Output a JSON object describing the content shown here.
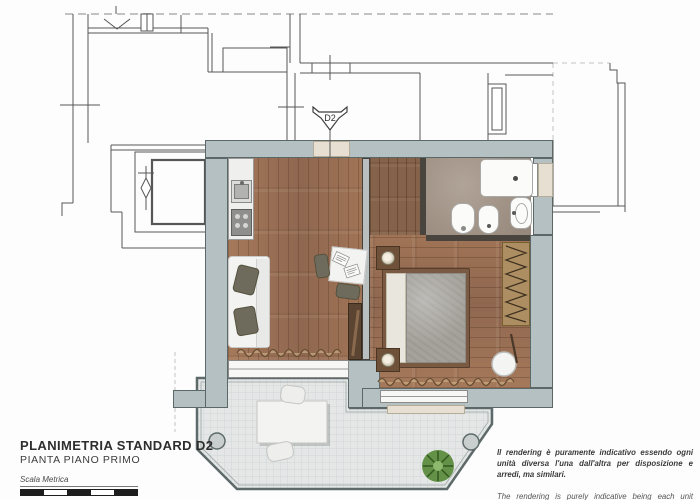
{
  "title_block": {
    "title": "PLANIMETRIA STANDARD D2",
    "subtitle": "PIANTA PIANO PRIMO",
    "scale_label": "Scala Metrica",
    "scale_ticks": [
      "0",
      "0,5",
      "1",
      "1,5",
      "2",
      "2,5"
    ]
  },
  "unit_marker": {
    "label": "D2"
  },
  "disclaimer": {
    "italian": "Il rendering è puramente indicativo essendo ogni unità diversa l'una dall'altra per disposizione e arredi, ma similari.",
    "english": "The rendering is purely indicative being each unit different from each other in layout and furnishings, but similar."
  },
  "colors": {
    "wall": "#b4c0c1",
    "wood_floor": "#9c7257",
    "hall_wood": "#85624a",
    "bathroom_floor": "#a39486",
    "terrace_tile": "#e4e7e6",
    "door_beige": "#e7e0d2",
    "text": "#2e2e2e"
  },
  "fixtures": [
    "entrance-door",
    "kitchen-sink",
    "cooktop",
    "sofa",
    "dining-table",
    "chairs",
    "console",
    "double-bed",
    "nightstand-lamps",
    "wardrobe",
    "stool",
    "shower-tray",
    "toilet",
    "bidet",
    "washbasin",
    "curtains",
    "outdoor-table",
    "outdoor-chairs",
    "floor-drains",
    "plant",
    "stairwell"
  ]
}
